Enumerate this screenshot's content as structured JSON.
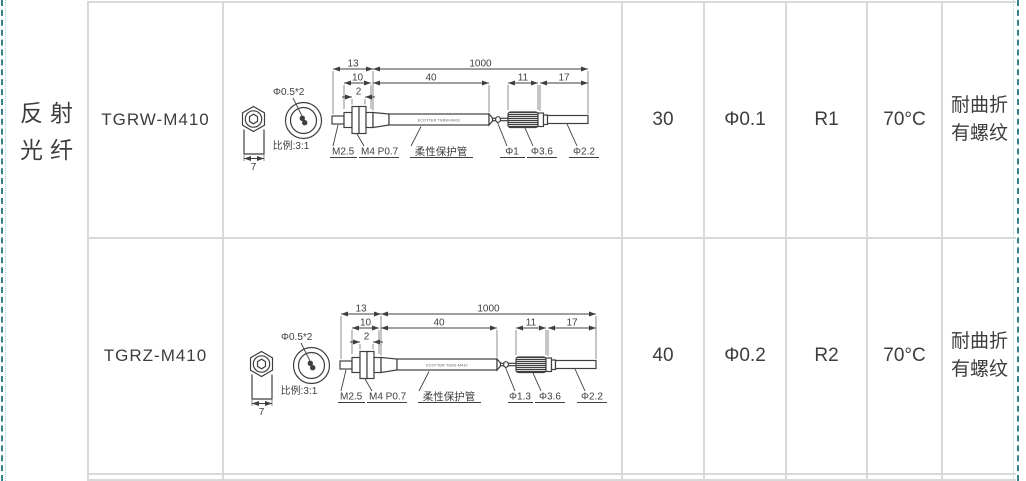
{
  "category": {
    "line1": "反射",
    "line2": "光纤"
  },
  "rows": [
    {
      "model": "TGRW-M410",
      "distance": "30",
      "spot": "Φ0.1",
      "bend_radius": "R1",
      "temperature": "70°C",
      "feature_line1": "耐曲折",
      "feature_line2": "有螺纹",
      "drawing": {
        "dim_head_len": "13",
        "dim_cable_len": "1000",
        "dim_thread_len": "10",
        "dim_tube_len": "40",
        "dim_knurl_len": "11",
        "dim_end_len": "17",
        "dim_flange": "2",
        "dim_hex": "7",
        "fiber_label": "Φ0.5*2",
        "scale_label": "比例:3:1",
        "front_thread_label": "M2.5",
        "body_thread_label": "M4 P0.7",
        "tube_label": "柔性保护管",
        "neck_label": "Φ1",
        "knurl_label": "Φ3.6",
        "rod_label": "Φ2.2",
        "tube_text": "ECOTTER TGRW-M410"
      }
    },
    {
      "model": "TGRZ-M410",
      "distance": "40",
      "spot": "Φ0.2",
      "bend_radius": "R2",
      "temperature": "70°C",
      "feature_line1": "耐曲折",
      "feature_line2": "有螺纹",
      "drawing": {
        "dim_head_len": "13",
        "dim_cable_len": "1000",
        "dim_thread_len": "10",
        "dim_tube_len": "40",
        "dim_knurl_len": "11",
        "dim_end_len": "17",
        "dim_flange": "2",
        "dim_hex": "7",
        "fiber_label": "Φ0.5*2",
        "scale_label": "比例:3:1",
        "front_thread_label": "M2.5",
        "body_thread_label": "M4 P0.7",
        "tube_label": "柔性保护管",
        "neck_label": "Φ1.3",
        "knurl_label": "Φ3.6",
        "rod_label": "Φ2.2",
        "tube_text": "ECOTTER TGRZ-M410"
      }
    }
  ]
}
